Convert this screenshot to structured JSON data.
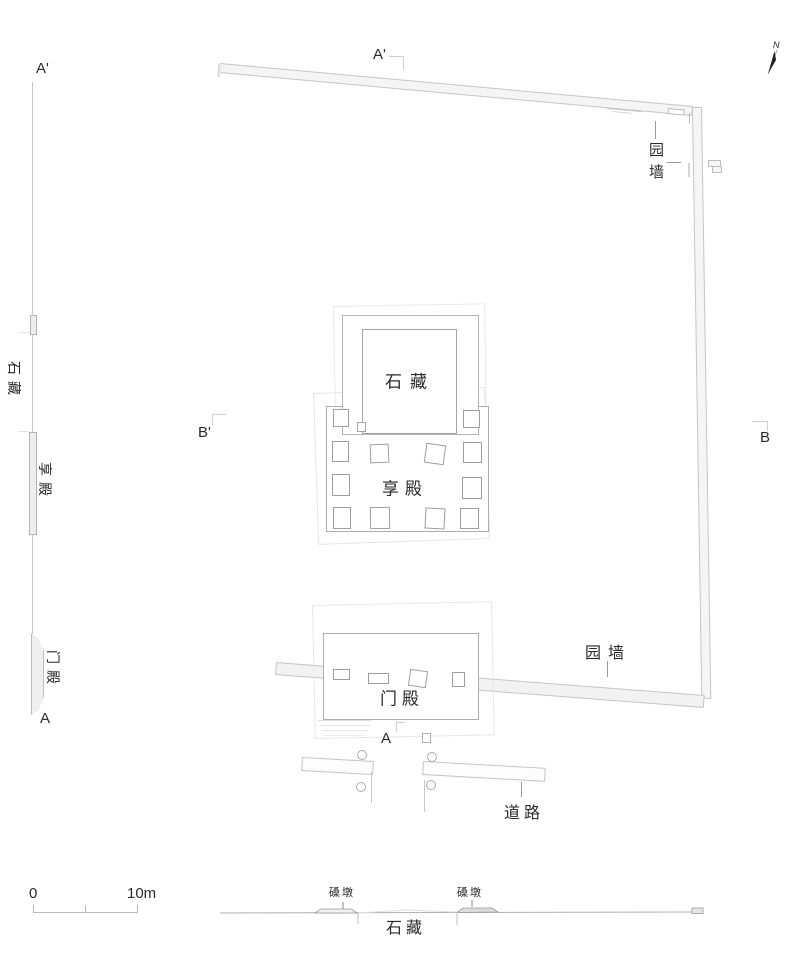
{
  "drawing": {
    "north_label": "N",
    "plan": {
      "section_a_top": "A'",
      "section_a_bottom": "A",
      "section_b_left": "B'",
      "section_b_right": "B",
      "wall_label_topright": "园墙",
      "wall_label_bottom": "园墙",
      "stone_chamber": "石藏",
      "offering_hall": "享殿",
      "gate_hall": "门殿",
      "road": "道路"
    },
    "section_left": {
      "mark_top": "A'",
      "mark_bottom": "A",
      "stone_chamber": "石藏",
      "offering_hall": "享殿",
      "gate_hall": "门殿"
    },
    "scale_bar": {
      "start": "0",
      "end": "10m"
    },
    "elevation_bottom": {
      "pier_left": "磉墩",
      "pier_right": "磉墩",
      "stone_chamber": "石藏"
    },
    "colors": {
      "wall_fill": "#f5f5f5",
      "wall_line": "#c6c6c6",
      "building_line": "#adadad",
      "text": "#2a2a2a",
      "pier_fill": "#dcdcdc"
    }
  }
}
